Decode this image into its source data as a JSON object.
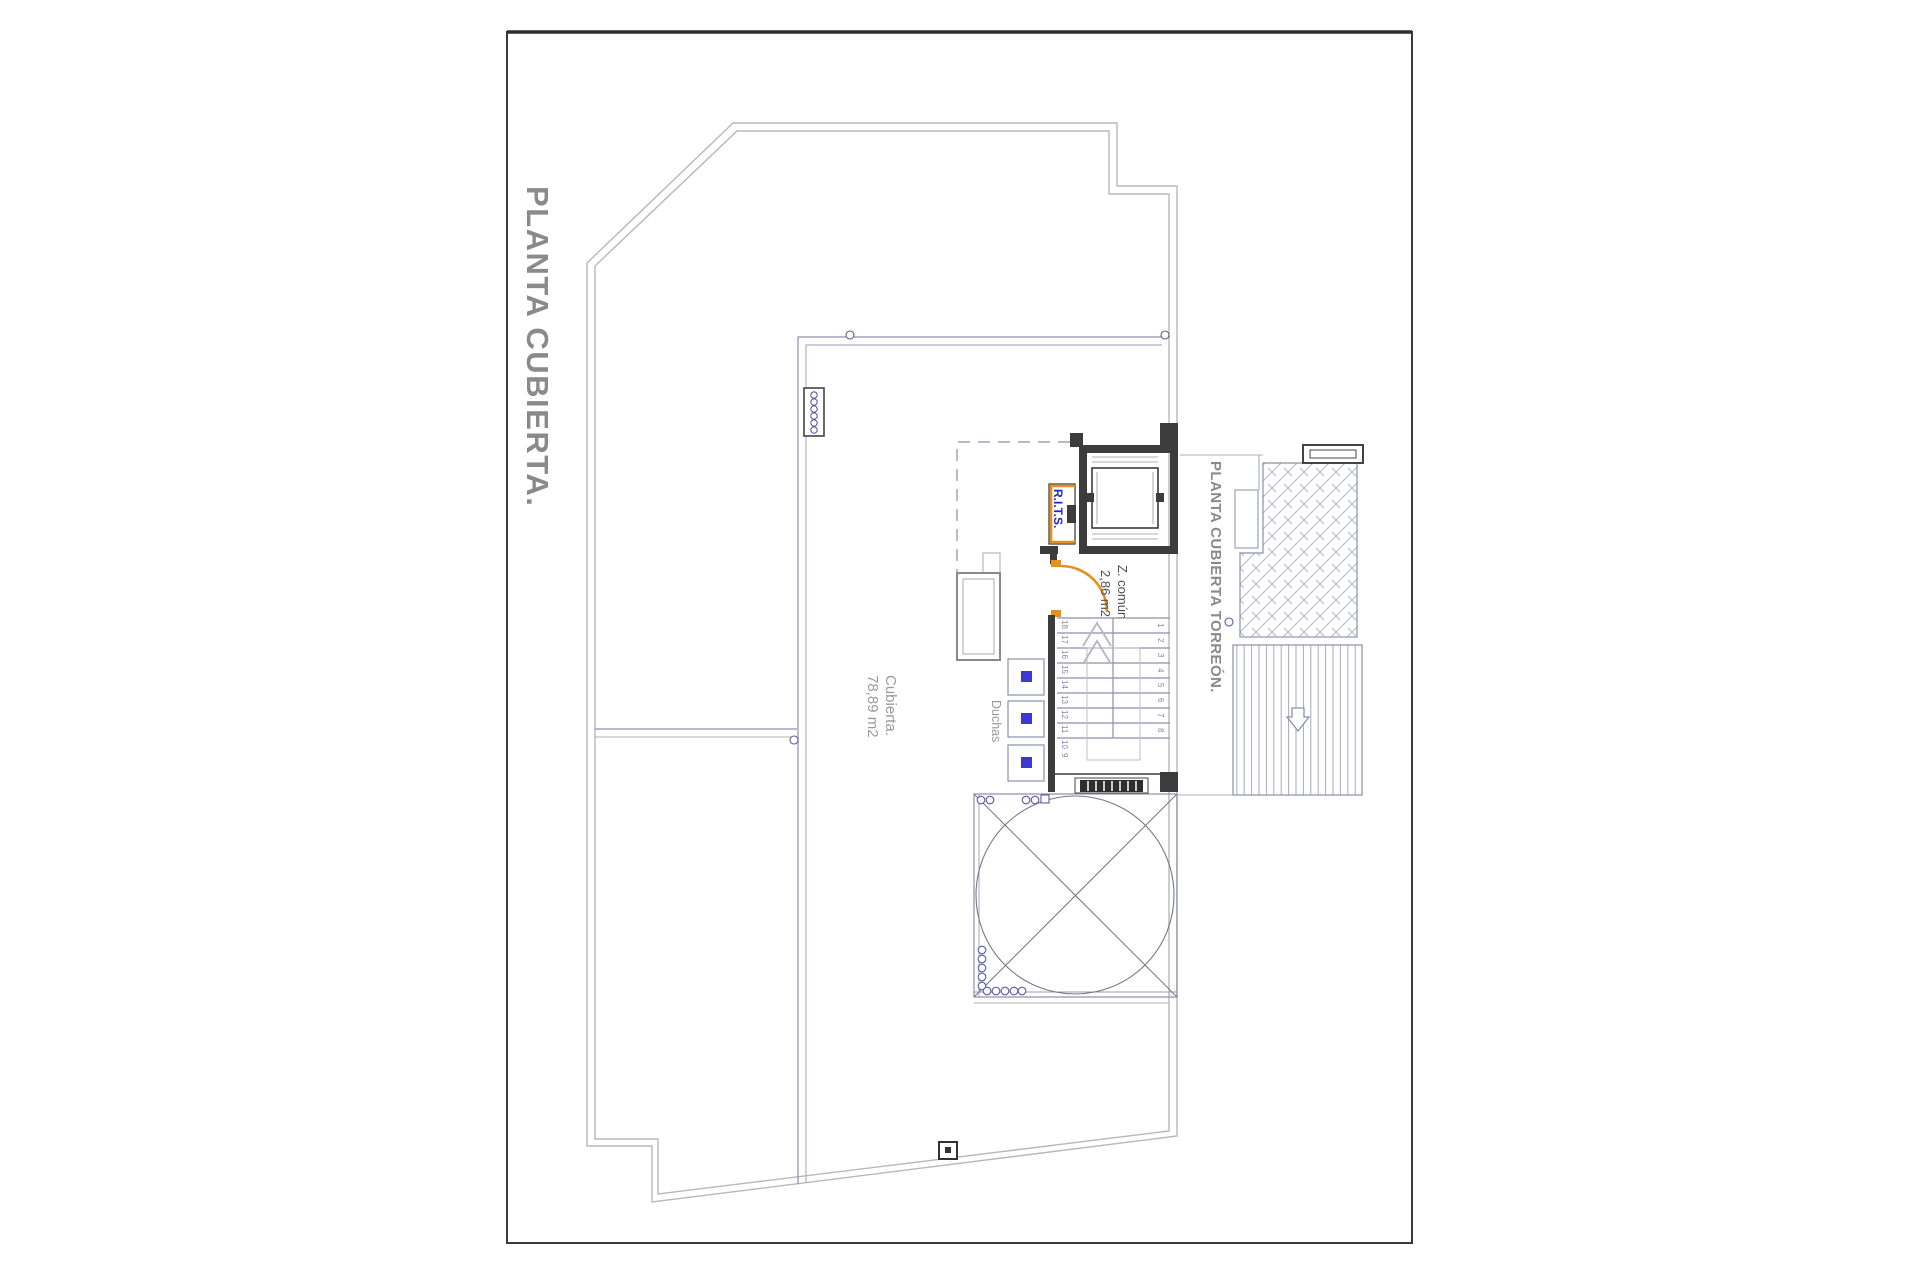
{
  "sheet": {
    "title_vertical": "PLANTA CUBIERTA."
  },
  "plan": {
    "area_label": {
      "line1": "Cubierta.",
      "line2": "78,89 m2"
    },
    "common_zone_label": {
      "line1": "Z. común",
      "line2": "2,86 m2"
    },
    "showers_label": "Duchas",
    "rits_label": "R.I.T.S.",
    "torreon_label": "PLANTA CUBIERTA TORREÓN.",
    "stairs": {
      "left_numbers": [
        "18",
        "17",
        "16",
        "15",
        "14",
        "13",
        "12",
        "11",
        "10",
        "9"
      ],
      "right_numbers": [
        "1",
        "2",
        "3",
        "4",
        "5",
        "6",
        "7",
        "8"
      ]
    }
  },
  "colors": {
    "accent_orange": "#E3901F",
    "label_blue": "#2424C8",
    "wall_dark": "#3C3C3C",
    "line_blue": "#8E8EAE",
    "outer_gray": "#B8B8B8",
    "title_gray": "#8A8A8A"
  }
}
